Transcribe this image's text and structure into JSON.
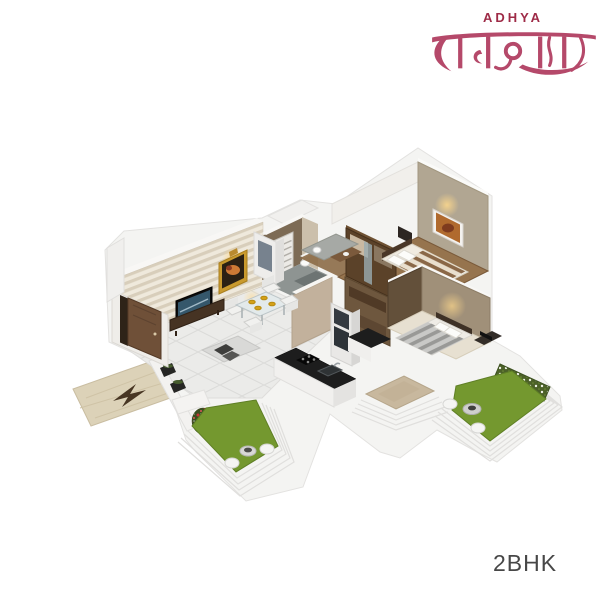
{
  "logo": {
    "brand": "ADHYA",
    "script": "राधाकृष्णा",
    "brand_color": "#9e2b47",
    "script_color": "#b5496a"
  },
  "caption": {
    "label": "2BHK",
    "color": "#474747"
  },
  "floorplan": {
    "type": "isometric-3d-render",
    "rooms": [
      "entrance-walkway",
      "living-room",
      "dining-area",
      "kitchen",
      "bathroom",
      "master-bedroom",
      "bedroom-2",
      "utility-balcony",
      "garden-terrace-left",
      "garden-terrace-right"
    ],
    "palette": {
      "wall_white": "#f4f4f2",
      "tile": "#ebebe9",
      "lawn": "#74982f",
      "lawn_dark": "#5f7f26",
      "wood": "#96744e",
      "wood_dark": "#7a5a3a",
      "taupe": "#b1a692",
      "brown_wall": "#6e573e",
      "counter": "#1d1d1d",
      "walkway": "#dcd2b8",
      "tan_floor": "#c8b89e",
      "gold": "#c99a2e"
    }
  }
}
